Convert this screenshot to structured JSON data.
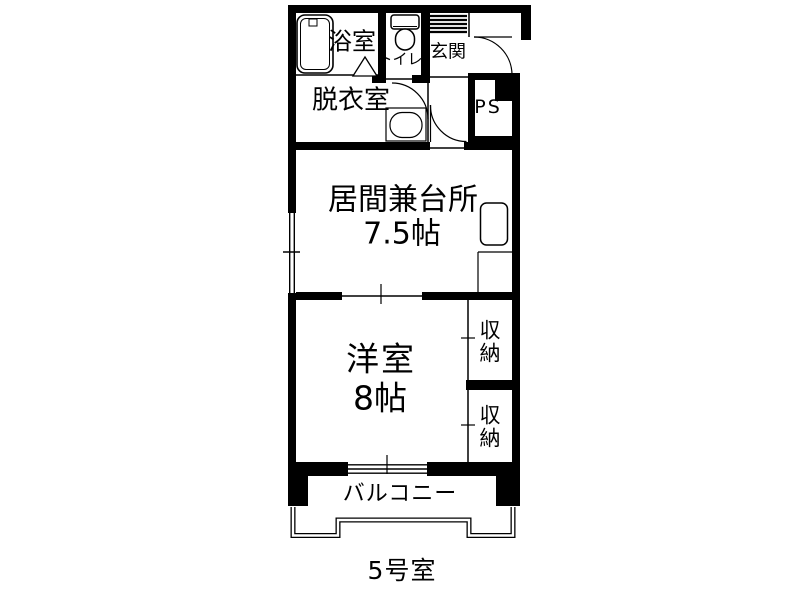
{
  "title": "間取り図",
  "unit": {
    "label": "5号室"
  },
  "rooms": {
    "bathroom": {
      "label": "浴室"
    },
    "toilet": {
      "label": "トイレ"
    },
    "entrance": {
      "label": "玄関"
    },
    "dressing_room": {
      "label": "脱衣室"
    },
    "pipe_space": {
      "label": "PS"
    },
    "living_kitchen": {
      "label": "居間兼台所",
      "size": "7.5帖"
    },
    "western_room": {
      "label": "洋室",
      "size": "8帖"
    },
    "closet_upper": {
      "label": "収納"
    },
    "closet_lower": {
      "label": "収納"
    },
    "balcony": {
      "label": "バルコニー"
    }
  },
  "fixtures": [
    "bathtub-icon",
    "toilet-icon",
    "washbasin-icon",
    "kitchen-sink-icon",
    "kitchen-counter",
    "entrance-door-arc",
    "toilet-door-arc",
    "hall-door-arc",
    "bath-folding-door-mark",
    "entrance-step-hatch",
    "window-left",
    "window-balcony",
    "sliding-door-line",
    "closet-door-line",
    "balcony-railing"
  ],
  "colors": {
    "line": "#000000",
    "background": "#ffffff"
  }
}
